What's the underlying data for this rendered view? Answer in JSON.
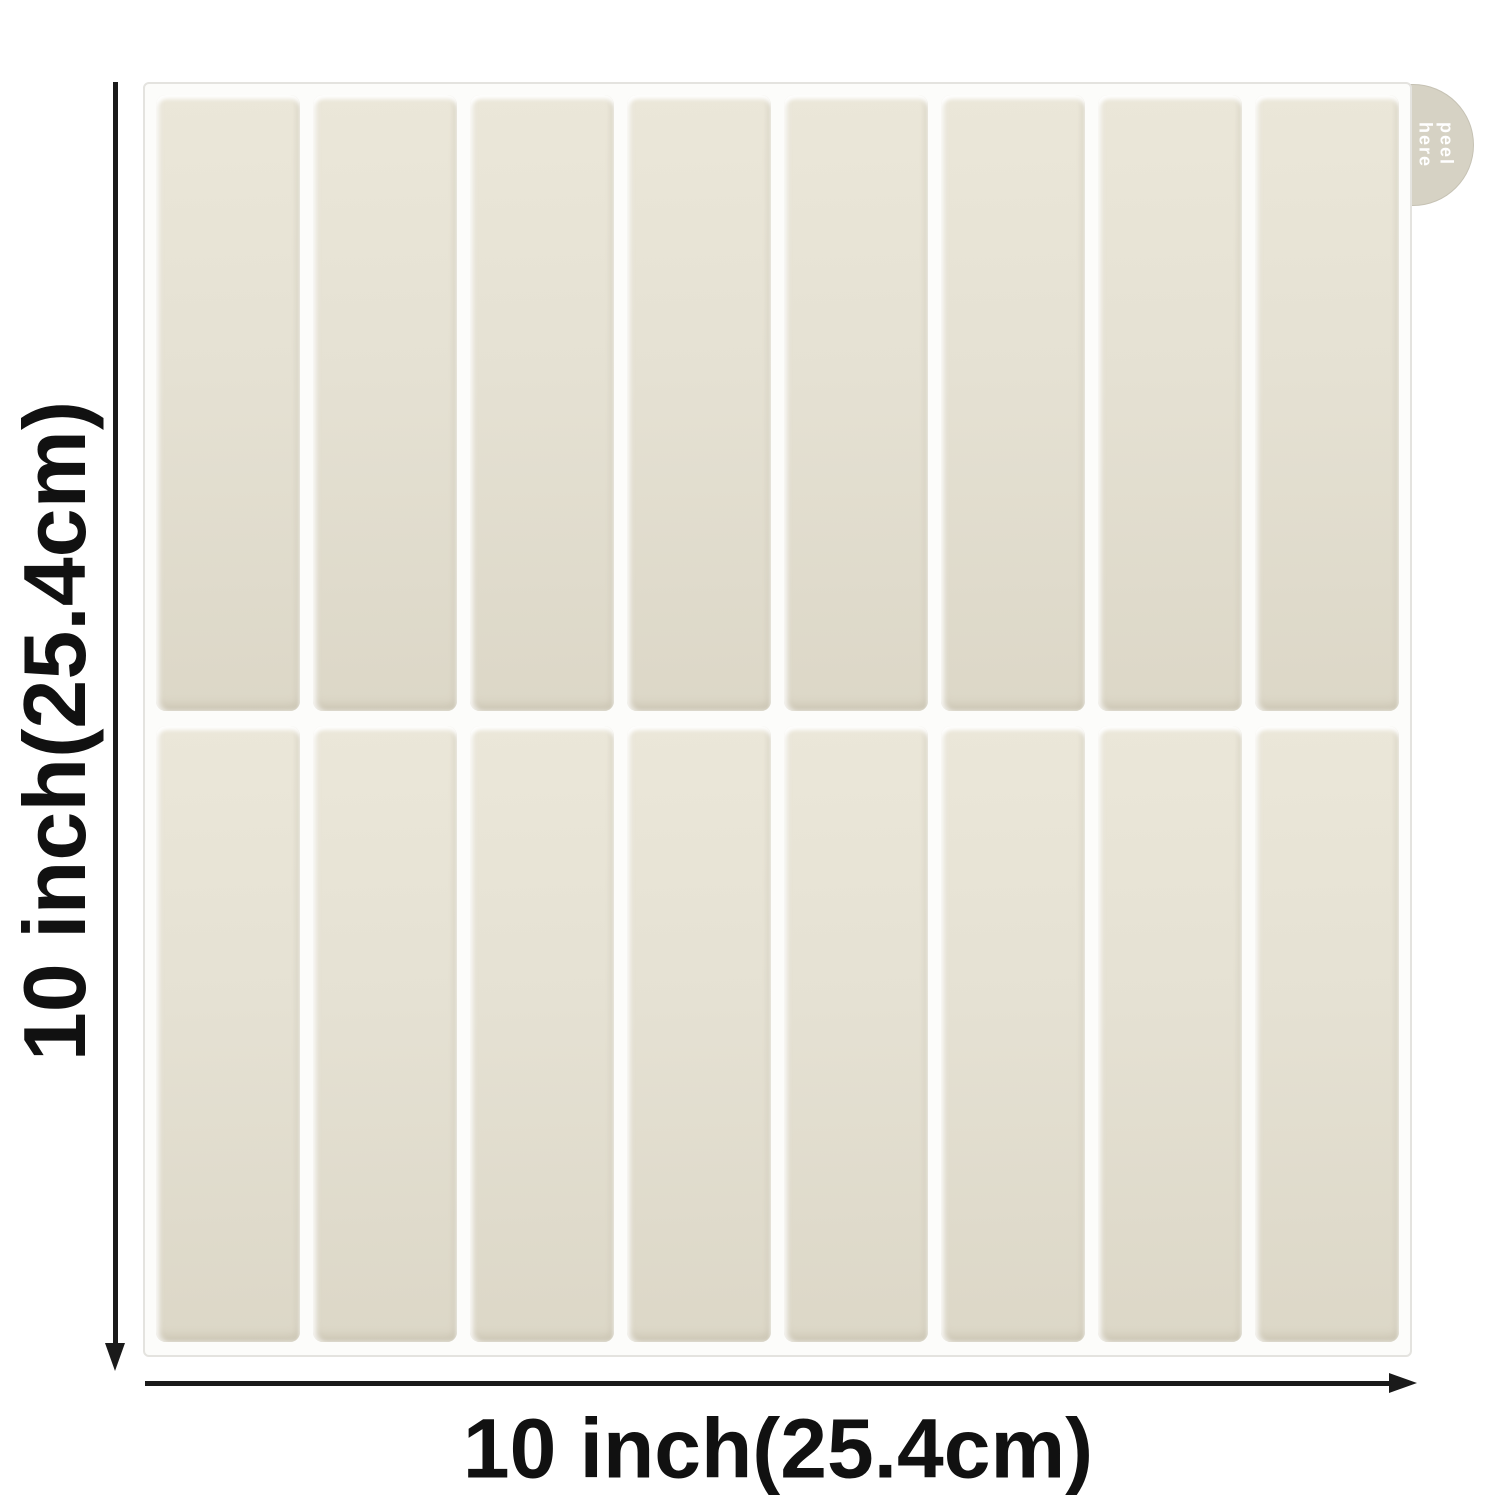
{
  "diagram": {
    "height_label": "10 inch(25.4cm)",
    "width_label": "10 inch(25.4cm)",
    "tab": {
      "line1": "peel",
      "line2": "here"
    },
    "sheet": {
      "columns": 8,
      "rows": 2,
      "tile_style": "vertical-stacked-subway"
    }
  },
  "colors": {
    "background": "#ffffff",
    "sheet_bg": "#fcfcfa",
    "sheet_border": "#e4e3df",
    "tile": "#e5e1d3",
    "grout": "#f7f6f2",
    "tab": "#d6d2c4",
    "tab_text": "#ffffff",
    "dimension": "#1a1a1a",
    "label": "#111111"
  }
}
